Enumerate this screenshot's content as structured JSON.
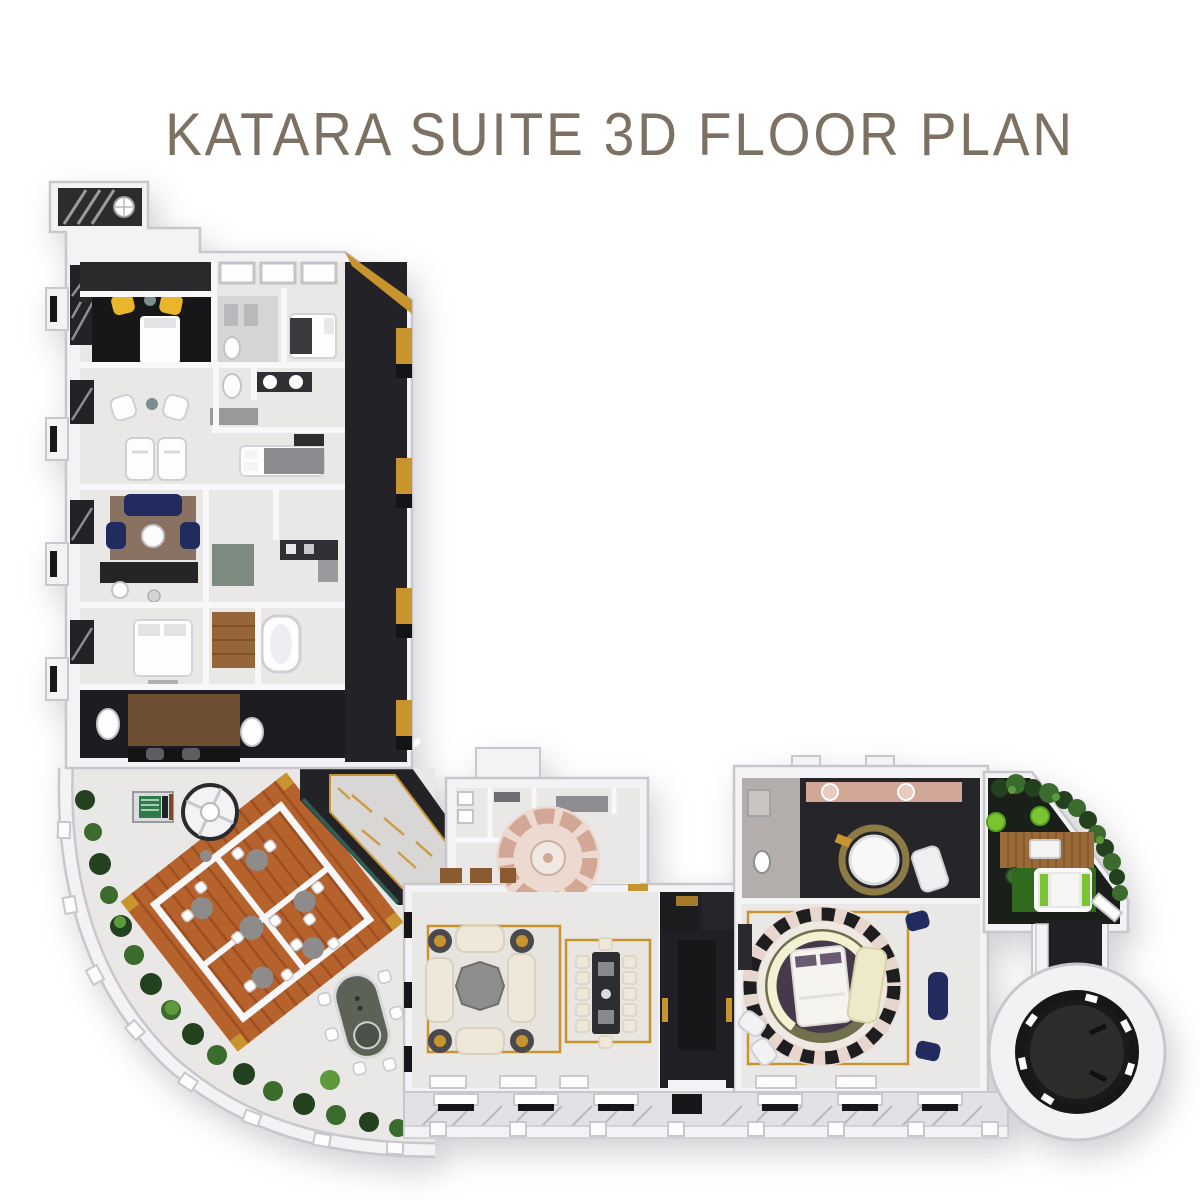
{
  "title": {
    "text": "KATARA SUITE 3D FLOOR PLAN"
  },
  "palette": {
    "background": "#ffffff",
    "title": "#7d7164",
    "wall": "#f3f3f5",
    "wall_shade": "#c7c7cd",
    "wall_line": "#f8f8fa",
    "floor": "#eae8e6",
    "floor_gray": "#d7d5d3",
    "marble": "#d9d7d5",
    "charcoal": "#232327",
    "black_room": "#17171a",
    "gold": "#c8942e",
    "yellow": "#e9b62b",
    "deck": "#b5622d",
    "deck_line": "#9e4f22",
    "wood": "#96653a",
    "navy": "#222b5e",
    "cream": "#efe8da",
    "cream_dark": "#d8d2c0",
    "plum": "#46394b",
    "olive": "#70704c",
    "pale_ring": "#f2f2d2",
    "rose": "#d2a795",
    "rose_light": "#ecd9cf",
    "teal": "#2e5c50",
    "plant_dark": "#23411e",
    "plant_mid": "#3c6b2e",
    "plant_light": "#5d9a3c",
    "lime": "#79c431",
    "grass": "#2f6a1f",
    "gray_furniture": "#8e8c8a",
    "brown_rug": "#8a7263",
    "table_dark": "#2e2e32",
    "white": "#fdfdfe"
  }
}
